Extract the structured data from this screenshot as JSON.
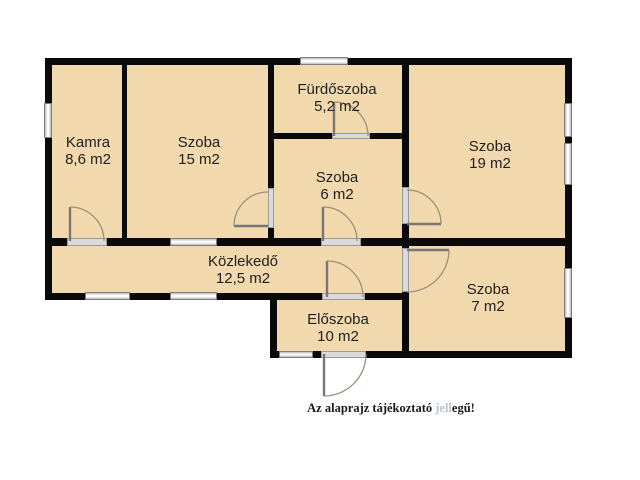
{
  "plan": {
    "rooms": [
      {
        "name": "Kamra",
        "area": "8,6 m2"
      },
      {
        "name": "Szoba",
        "area": "15 m2"
      },
      {
        "name": "Fürdőszoba",
        "area": "5,2 m2"
      },
      {
        "name": "Szoba",
        "area": "6 m2"
      },
      {
        "name": "Szoba",
        "area": "19 m2"
      },
      {
        "name": "Közlekedő",
        "area": "12,5 m2"
      },
      {
        "name": "Előszoba",
        "area": "10 m2"
      },
      {
        "name": "Szoba",
        "area": "7 m2"
      }
    ],
    "note": {
      "part1": "Az alaprajz tájékoztató ",
      "part2": "jell",
      "part3": "egű!"
    },
    "colors": {
      "room_fill": "#f2d8ad",
      "wall": "#0a0a0a",
      "faded_text": "#b9c3d2"
    }
  }
}
